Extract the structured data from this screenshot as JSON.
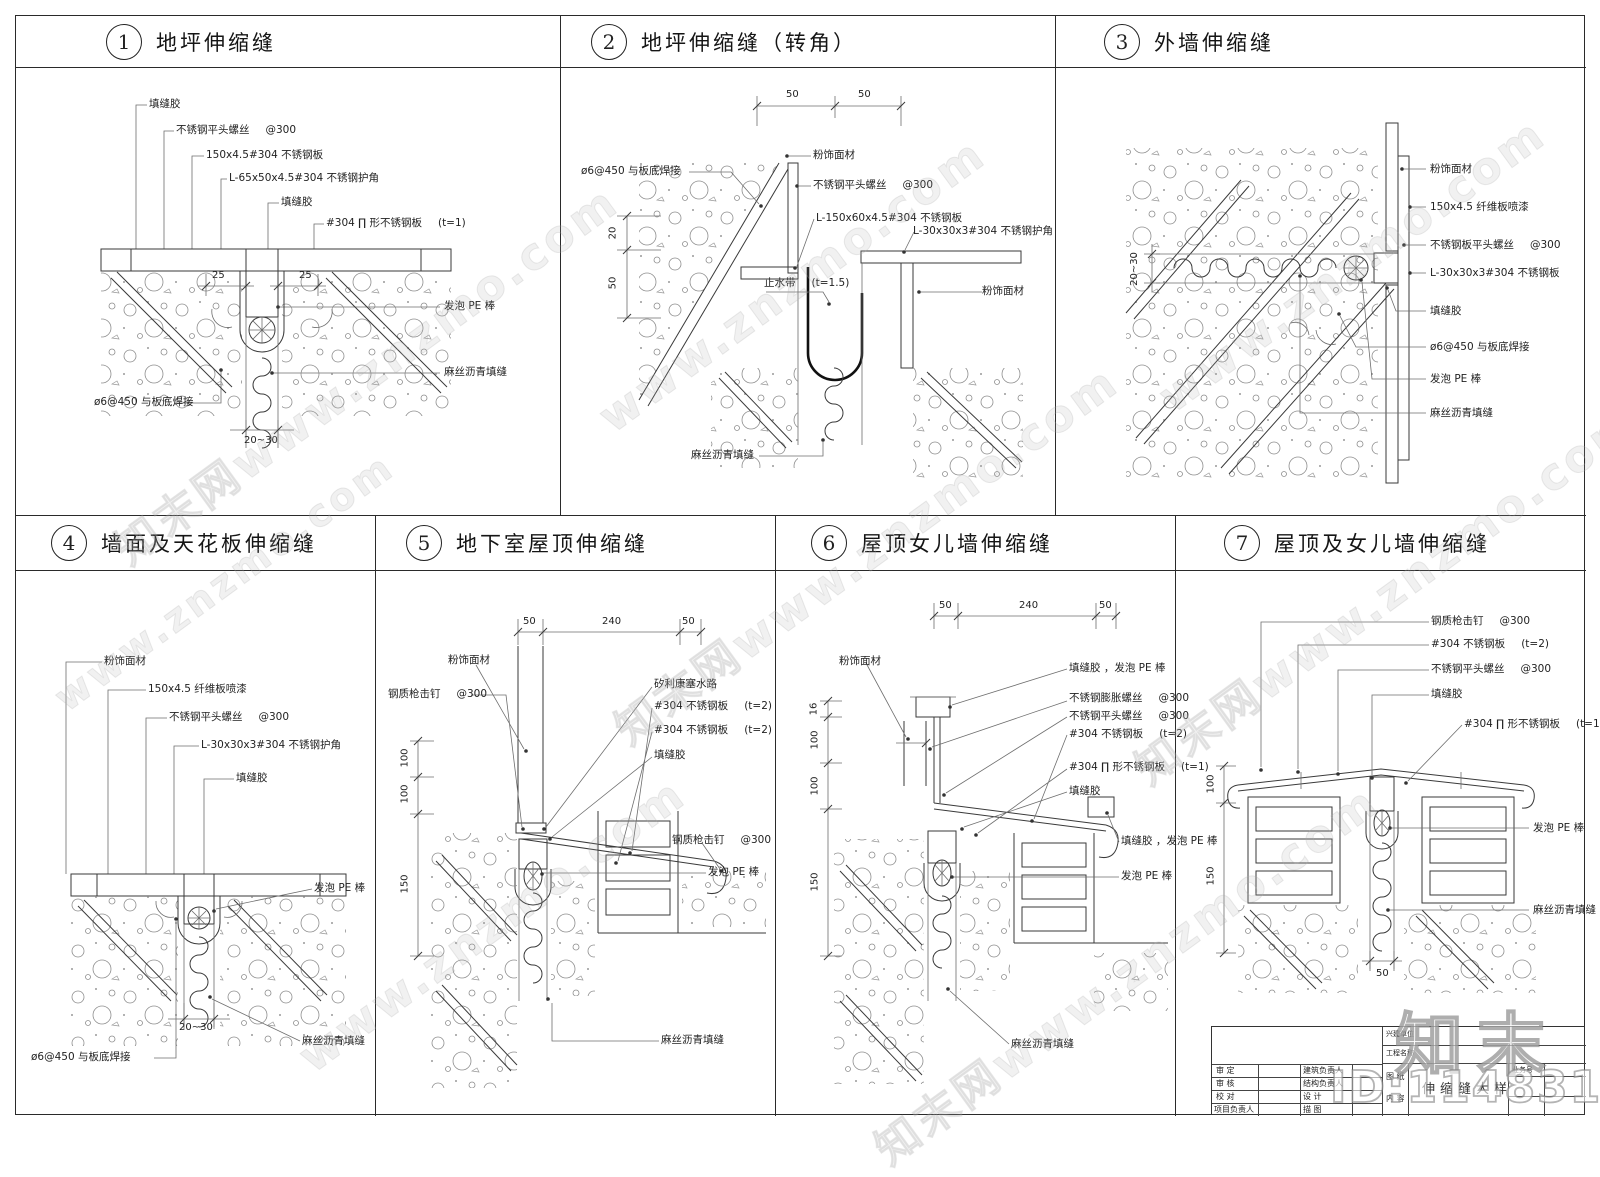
{
  "sheet": {
    "background": "#ffffff",
    "line_color": "#2a2a2a"
  },
  "watermark": {
    "brand": "知末",
    "site": "www.znzmo.com",
    "brand_site": "知末网www.znzmo.com",
    "id_text": "ID:1148312042"
  },
  "panels": [
    {
      "num": "1",
      "title": "地坪伸缩缝",
      "labels": [
        {
          "text": "填缝胶"
        },
        {
          "text": "不锈钢平头螺丝",
          "suffix": "@300"
        },
        {
          "text": "150x4.5#304 不锈钢板"
        },
        {
          "text": "L-65x50x4.5#304 不锈钢护角"
        },
        {
          "text": "填缝胶"
        },
        {
          "text": "#304 ∏ 形不锈钢板",
          "suffix": "(t=1)"
        },
        {
          "text": "发泡 PE 棒"
        },
        {
          "text": "麻丝沥青填缝"
        },
        {
          "text": "ø6@450 与板底焊接"
        }
      ],
      "dims": [
        "25",
        "25",
        "20~30"
      ]
    },
    {
      "num": "2",
      "title": "地坪伸缩缝（转角）",
      "labels": [
        {
          "text": "ø6@450 与板底焊接"
        },
        {
          "text": "粉饰面材"
        },
        {
          "text": "不锈钢平头螺丝",
          "suffix": "@300"
        },
        {
          "text": "L-150x60x4.5#304 不锈钢板"
        },
        {
          "text": "L-30x30x3#304 不锈钢护角"
        },
        {
          "text": "止水带",
          "suffix": "(t=1.5)"
        },
        {
          "text": "粉饰面材"
        },
        {
          "text": "麻丝沥青填缝"
        }
      ],
      "dims": [
        "50",
        "50",
        "20",
        "50"
      ]
    },
    {
      "num": "3",
      "title": "外墙伸缩缝",
      "labels": [
        {
          "text": "粉饰面材"
        },
        {
          "text": "150x4.5 纤维板喷漆"
        },
        {
          "text": "不锈钢板平头螺丝",
          "suffix": "@300"
        },
        {
          "text": "L-30x30x3#304 不锈钢板"
        },
        {
          "text": "填缝胶"
        },
        {
          "text": "ø6@450 与板底焊接"
        },
        {
          "text": "发泡 PE 棒"
        },
        {
          "text": "麻丝沥青填缝"
        }
      ],
      "dims": [
        "20~30"
      ]
    },
    {
      "num": "4",
      "title": "墙面及天花板伸缩缝",
      "labels": [
        {
          "text": "粉饰面材"
        },
        {
          "text": "150x4.5 纤维板喷漆"
        },
        {
          "text": "不锈钢平头螺丝",
          "suffix": "@300"
        },
        {
          "text": "L-30x30x3#304 不锈钢护角"
        },
        {
          "text": "填缝胶"
        },
        {
          "text": "发泡 PE 棒"
        },
        {
          "text": "麻丝沥青填缝"
        },
        {
          "text": "ø6@450 与板底焊接"
        }
      ],
      "dims": [
        "20~30"
      ]
    },
    {
      "num": "5",
      "title": "地下室屋顶伸缩缝",
      "labels": [
        {
          "text": "粉饰面材"
        },
        {
          "text": "钢质枪击钉",
          "suffix": "@300"
        },
        {
          "text": "矽利康塞水路"
        },
        {
          "text": "#304 不锈钢板",
          "suffix": "(t=2)"
        },
        {
          "text": "#304 不锈钢板",
          "suffix": "(t=2)"
        },
        {
          "text": "填缝胶"
        },
        {
          "text": "钢质枪击钉",
          "suffix": "@300"
        },
        {
          "text": "发泡 PE 棒"
        },
        {
          "text": "麻丝沥青填缝"
        }
      ],
      "dims": [
        "50",
        "240",
        "50",
        "100",
        "100",
        "150"
      ]
    },
    {
      "num": "6",
      "title": "屋顶女儿墙伸缩缝",
      "labels": [
        {
          "text": "粉饰面材"
        },
        {
          "text": "填缝胶 ，发泡 PE 棒"
        },
        {
          "text": "不锈钢膨胀螺丝",
          "suffix": "@300"
        },
        {
          "text": "不锈钢平头螺丝",
          "suffix": "@300"
        },
        {
          "text": "#304 不锈钢板",
          "suffix": "(t=2)"
        },
        {
          "text": "#304 ∏ 形不锈钢板",
          "suffix": "(t=1)"
        },
        {
          "text": "填缝胶"
        },
        {
          "text": "填缝胶 ，发泡 PE 棒"
        },
        {
          "text": "发泡 PE 棒"
        },
        {
          "text": "麻丝沥青填缝"
        }
      ],
      "dims": [
        "50",
        "240",
        "50",
        "16",
        "100",
        "100",
        "150"
      ]
    },
    {
      "num": "7",
      "title": "屋顶及女儿墙伸缩缝",
      "labels": [
        {
          "text": "钢质枪击钉",
          "suffix": "@300"
        },
        {
          "text": "#304 不锈钢板",
          "suffix": "(t=2)"
        },
        {
          "text": "不锈钢平头螺丝",
          "suffix": "@300"
        },
        {
          "text": "填缝胶"
        },
        {
          "text": "#304 ∏ 形不锈钢板",
          "suffix": "(t=1)"
        },
        {
          "text": "发泡 PE 棒"
        },
        {
          "text": "麻丝沥青填缝"
        }
      ],
      "dims": [
        "100",
        "150",
        "50"
      ]
    }
  ],
  "title_block": {
    "rows_left": [
      "审  定",
      "审  核",
      "校  对",
      "项目负责人"
    ],
    "rows_mid": [
      "建筑负责人",
      "结构负责人",
      "设  计",
      "描  图"
    ],
    "owner_label": "兴建单位",
    "project_label": "工程名称",
    "content_label_1": "图  纸",
    "content_label_2": "内  容",
    "content_text": "伸缩缝大样",
    "job_no_label": "业务号"
  }
}
